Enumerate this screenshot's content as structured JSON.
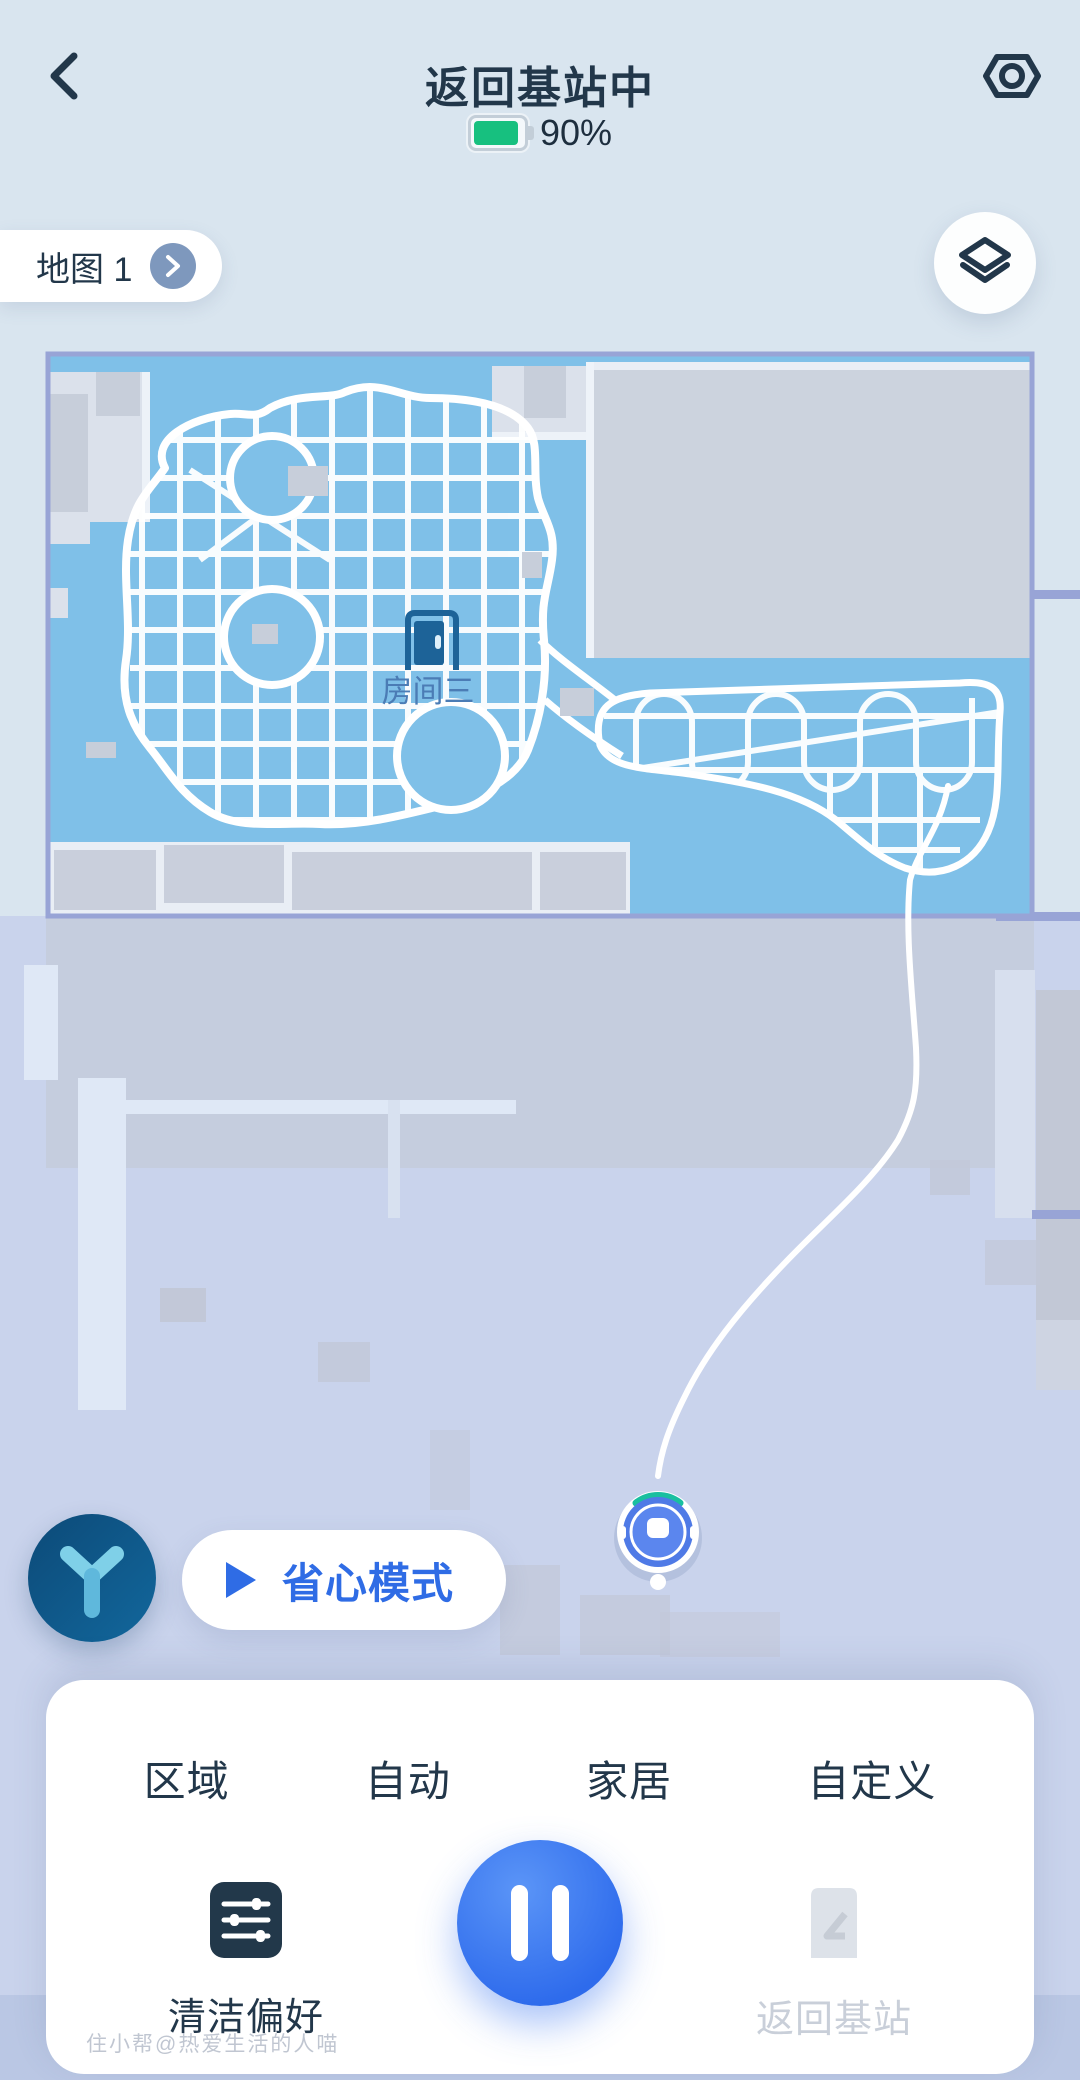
{
  "header": {
    "title": "返回基站中",
    "battery_percent": "90%"
  },
  "map_bar": {
    "map_label": "地图 1"
  },
  "map": {
    "room_label": "房间三"
  },
  "mode": {
    "label": "省心模式"
  },
  "tabs": [
    {
      "label": "区域"
    },
    {
      "label": "自动"
    },
    {
      "label": "家居"
    },
    {
      "label": "自定义"
    }
  ],
  "controls": {
    "preferences_label": "清洁偏好",
    "pause_state": "pause",
    "return_label": "返回基站"
  },
  "watermark": "住小帮@热爱生活的人喵",
  "colors": {
    "accent_blue": "#2f6ce5",
    "battery_green": "#17c07f",
    "cleaned_area_blue": "#7fc0e8",
    "map_border": "#98a4d6",
    "disabled_gray": "#c9cfd9"
  }
}
